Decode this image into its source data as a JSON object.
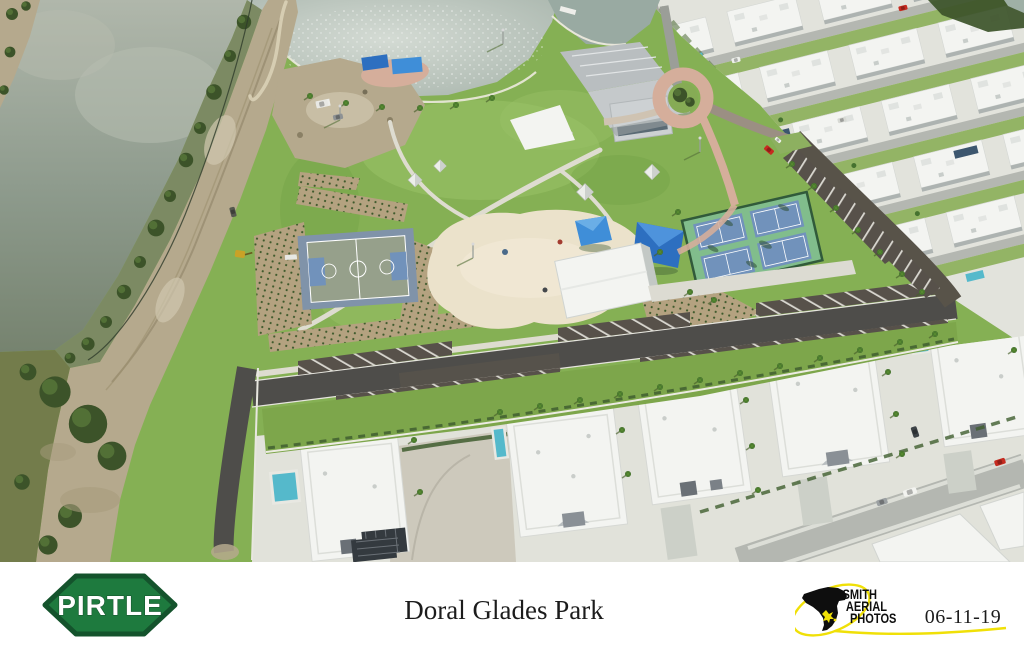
{
  "footer": {
    "builder_logo": {
      "label": "PIRTLE"
    },
    "title": "Doral Glades Park",
    "photographer_logo": {
      "lines": [
        "SMITH",
        "AERIAL",
        "PHOTOS"
      ]
    },
    "date": "06-11-19"
  },
  "photo": {
    "description": "Aerial view of Doral Glades Park: lake and tree berm on the left, new park with basketball court, sand playground, blue shade canopies, tennis courts, pavilions and parking, surrounded by white modern townhomes",
    "palette": {
      "water-left": "#93a092",
      "water-left-light": "#b7bdb0",
      "lake": "#c6cfc8",
      "lake-edge": "#9fb0a6",
      "dirt": "#b5a98d",
      "dirt-light": "#d0c7af",
      "scrub": "#737c4b",
      "tree-dark": "#3c5329",
      "tree-mid": "#527036",
      "grass": "#85b054",
      "grass-light": "#9cc468",
      "grass-dark": "#6d9a43",
      "sand": "#ebe2cb",
      "mulch": "#b4a280",
      "bball-border": "#8093a9",
      "bball-inner": "#96a08b",
      "court-blue": "#7192bb",
      "tennis-green": "#81bd8c",
      "fence-green": "#315a3a",
      "canopy-blue": "#3f8ed8",
      "canopy-blue-dark": "#2d6fc0",
      "paved-pink": "#d5ae9b",
      "concrete": "#dcdbd2",
      "sidewalk": "#dedcd0",
      "asphalt": "#4e4d4a",
      "asphalt-lot": "#57514a",
      "street": "#b4b7b1",
      "roof-white": "#f3f4f1",
      "roof-shade": "#c3c8c5",
      "metal-roof": "#b9bec0",
      "solar-panel": "#3c566e",
      "pool-blue": "#55b9cb",
      "car-red": "#c62b20",
      "equip-yellow": "#c9a227",
      "pirtle-green": "#1e7a3e",
      "pirtle-dark": "#14532c",
      "smith-yellow": "#f0e007",
      "ink": "#1c1c1c"
    }
  }
}
